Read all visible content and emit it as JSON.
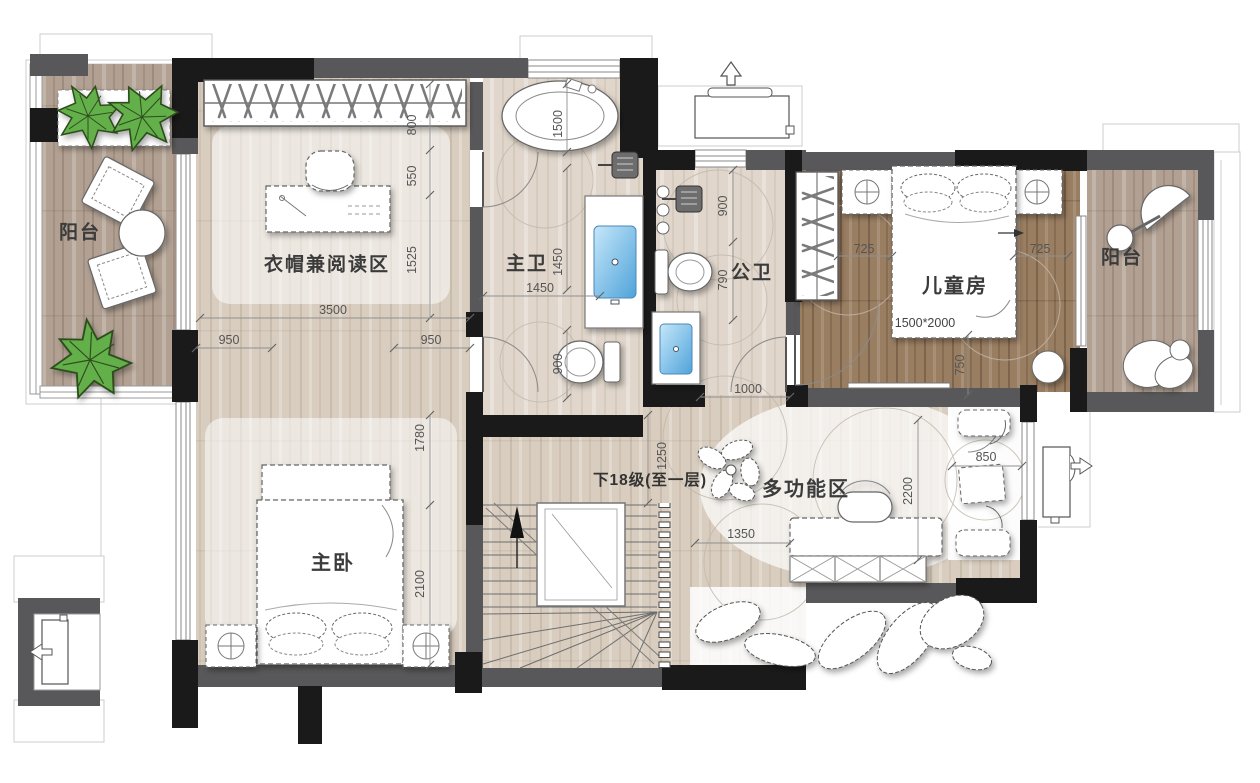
{
  "rooms": {
    "balcony_left": "阳台",
    "cloak_reading": "衣帽兼阅读区",
    "master_bath": "主卫",
    "public_bath": "公卫",
    "kids_room": "儿童房",
    "balcony_right": "阳台",
    "master_bedroom": "主卧",
    "multi_function": "多功能区",
    "stairs_note": "下18级(至一层)"
  },
  "furniture": {
    "kids_bed_size": "1500*2000"
  },
  "dims": {
    "d800": "800",
    "d550": "550",
    "d1525": "1525",
    "d3500": "3500",
    "d950_left": "950",
    "d950_right": "950",
    "d1500": "1500",
    "d1450_v": "1450",
    "d1450_h": "1450",
    "d900_bath": "900",
    "d900_pub": "900",
    "d790": "790",
    "d1000": "1000",
    "d725_left": "725",
    "d725_right": "725",
    "d750": "750",
    "d1780": "1780",
    "d2100": "2100",
    "d1250": "1250",
    "d1350": "1350",
    "d2200": "2200",
    "d850": "850"
  },
  "colors": {
    "wall_dark": "#1a1a1a",
    "wall_gray": "#58585a",
    "wood_light": "#d8cdbf",
    "wood_dark": "#9a7e62",
    "wood_balcony": "#b2a193",
    "wood_bath": "#e0d6cb",
    "sink_blue": "#6fb9e8",
    "plant_green": "#64af4a",
    "dim_text": "#555555",
    "label_text": "#3b3b3b"
  }
}
